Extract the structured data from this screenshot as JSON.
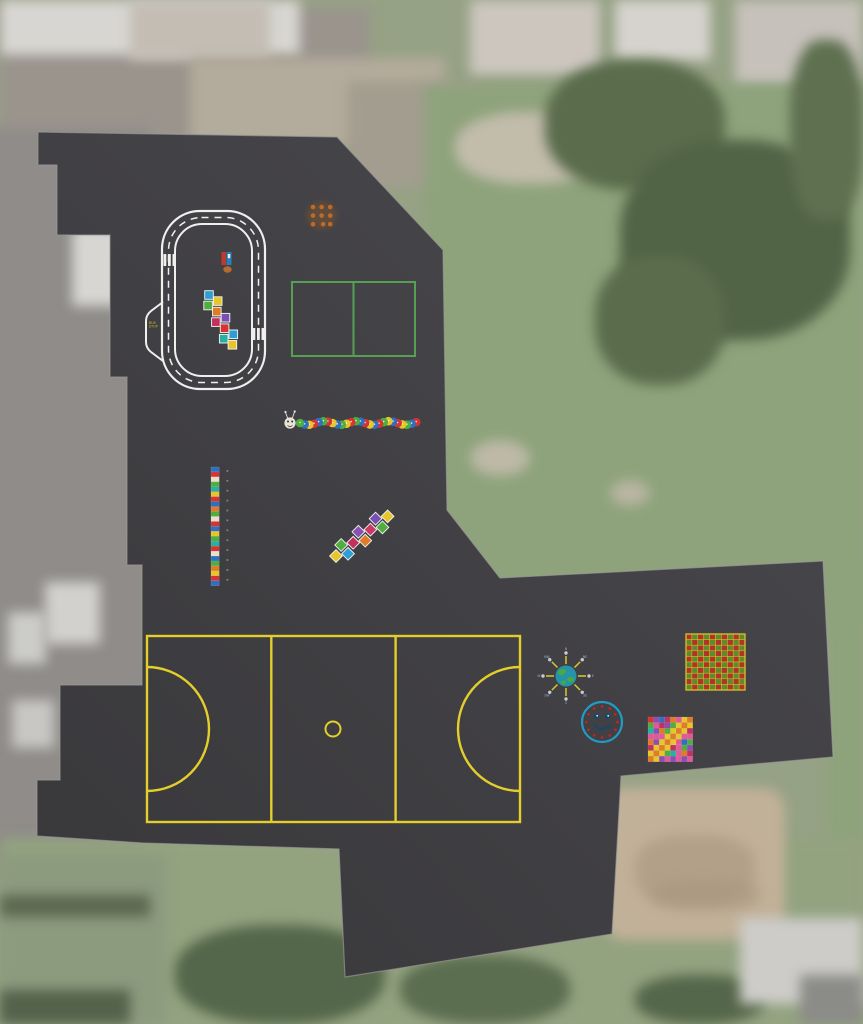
{
  "labels": {
    "bus_stop": "BUS STOP"
  },
  "colors": {
    "tarmac": "#38373a",
    "tarmac_edge": "#4a494e",
    "kerb": "#9b9b98",
    "track_line": "#f0efed",
    "bus_stop_text": "#d8c22e",
    "court_yellow": "#e3ce2c",
    "mini_court_green": "#55a055",
    "clock_ring": "#1f9dc4",
    "clock_tick": "#cc2222",
    "clock_face": "#16486e",
    "compass_sea": "#2593a8",
    "compass_land": "#49a845",
    "compass_ray": "#d8c832",
    "compass_tip": "#c8ccd0",
    "compass_letter": "#9fb3c8",
    "dots_orange": "#c06a28",
    "dots_smudge": "#8a5a2a",
    "grid_red": "#b23327",
    "grid_green": "#5f8c2a",
    "grid_line": "#d8c22e",
    "pump_red": "#c0392b",
    "pump_blue": "#2980b9",
    "pump_base": "#b7692e",
    "caterpillar_head": "#e9e5d6",
    "number_tick": "#b9c48a",
    "snakes_diagonal": "#e8c52a",
    "snakes_diagonal_alt": "#e07b28"
  },
  "compass_points": [
    "N",
    "NE",
    "E",
    "SE",
    "S",
    "SW",
    "W",
    "NW"
  ],
  "clock": {
    "tick_count": 12
  },
  "palettes": {
    "hopscotch_track": [
      "#2e9fd4",
      "#4fae3f",
      "#e8c52a",
      "#e07b28",
      "#c2305e",
      "#7a4fb5",
      "#d63333",
      "#28b0a0",
      "#2e9fd4",
      "#e8c52a"
    ],
    "hopscotch_diagonal": [
      "#e8c52a",
      "#4fae3f",
      "#2e9fd4",
      "#c2305e",
      "#8a4fb5",
      "#e07b28",
      "#c93a67",
      "#7a4fb5",
      "#4fae3f",
      "#e8c52a"
    ],
    "caterpillar_body": [
      "#4fae3f",
      "#2e6fc4",
      "#e8c52a",
      "#d63333",
      "#2e6fc4",
      "#4fae3f",
      "#d63333",
      "#e8c52a",
      "#2e6fc4",
      "#4fae3f",
      "#e8c52a",
      "#d63333",
      "#4fae3f",
      "#2e6fc4",
      "#d63333",
      "#e8c52a",
      "#2e6fc4",
      "#d63333",
      "#4fae3f",
      "#e8c52a",
      "#2e6fc4",
      "#d63333",
      "#e8c52a",
      "#4fae3f",
      "#2e6fc4",
      "#d63333"
    ],
    "number_line": [
      "#2e6fc4",
      "#d63333",
      "#e8e0c8",
      "#4fae3f",
      "#28b0a0",
      "#e8c52a",
      "#d63333",
      "#2e6fc4",
      "#e07b28",
      "#4fae3f",
      "#e8e0c8",
      "#d63333",
      "#2e6fc4",
      "#e8c52a",
      "#4fae3f",
      "#28b0a0",
      "#d63333",
      "#e8e0c8",
      "#2e6fc4",
      "#4fae3f",
      "#e07b28",
      "#e8c52a",
      "#d63333",
      "#2e6fc4"
    ],
    "grid_cells": [
      "#b23327",
      "#5f8c2a"
    ],
    "snakes_grid": [
      "#d63333",
      "#e05a9a",
      "#2e6fc4",
      "#4fae3f",
      "#e07b28",
      "#8a4fb5",
      "#28b0a0",
      "#c2305e"
    ]
  }
}
